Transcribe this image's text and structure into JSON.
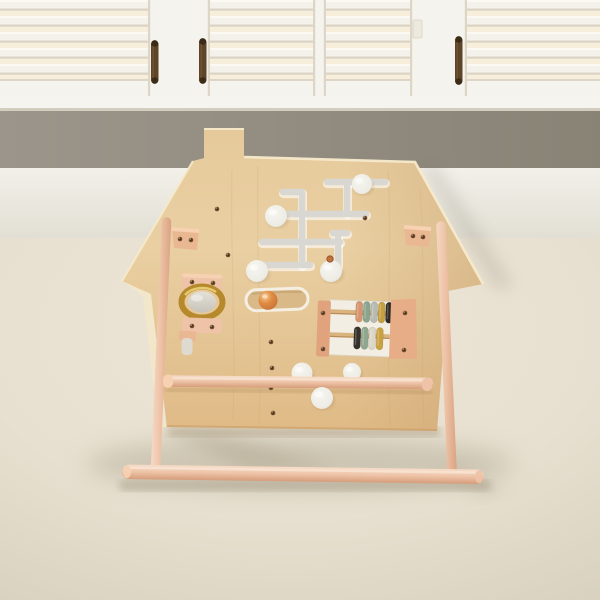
{
  "scene": {
    "subject": "wooden house-shaped activity busy board on an a-frame stand, in front of white plantation shutters on a cream carpet"
  },
  "palette": {
    "shutter_slat_bright": "#fbf9f4",
    "shutter_slat": "#f4f1ea",
    "shutter_gap_shadow": "#dbd3c4",
    "shutter_gap_glow": "#f7eedc",
    "shutter_frame": "#f5f3ee",
    "shutter_frame_shadow": "#ddd5c6",
    "rod": "#5f4527",
    "rod_dark": "#3c2b17",
    "sill": "#f6f4ef",
    "sill_shadow": "#d3cdc0",
    "wall_gray_left": "#9b958b",
    "wall_gray_right": "#898376",
    "wall_lower": "#f2f0e9",
    "wall_lower_dark": "#e2dfd4",
    "floor": "#e7e0d0",
    "floor_light": "#ede6d7",
    "floor_dark": "#d8d0bd",
    "shadow": "#b3aa94",
    "board_top": "#e6ca9c",
    "board_mid": "#e9cfa2",
    "board_bottom": "#dfba86",
    "board_dark": "#c89a64",
    "board_edge": "#f7eacb",
    "board_cut": "#f3e7c9",
    "grain": "#c29a68",
    "stand_light": "#f6dcc8",
    "stand_mid": "#eec3a7",
    "stand_dark": "#d59d7b",
    "bracket": "#eab793",
    "bracket_light": "#f6d2b2",
    "track": "#d9d7d2",
    "knob_center": "#f7f5ef",
    "knob_edge": "#d7d4ca",
    "screw": "#6e4a2c",
    "gold": "#b68a2c",
    "gold_hi": "#ecd077",
    "mirror_top": "#e4e1d9",
    "mirror_bottom": "#c7c3b9",
    "slot_fill": "#d9b988",
    "slot_edge": "#f4efe2",
    "slot_shadow": "#bb9768",
    "ball": "#e08c44",
    "ball_dark": "#c06a32",
    "ball_hi": "#f7c98e",
    "peg": "#c0703e",
    "abacus_bg": "#f2eee3",
    "abacus_post": "#e0a37e",
    "abacus_plate": "#e7ad86",
    "rail_wood": "#dab47f",
    "rail_wood_dark": "#b98c57"
  },
  "shutters": {
    "dividers": [
      {
        "x": 148,
        "w": 62
      },
      {
        "x": 313,
        "w": 13
      },
      {
        "x": 410,
        "w": 57
      }
    ],
    "rods": [
      {
        "x": 151,
        "y": 41,
        "h": 42
      },
      {
        "x": 199,
        "y": 39,
        "h": 44
      },
      {
        "x": 455,
        "y": 37,
        "h": 47
      }
    ]
  },
  "maze": {
    "tracks": [
      [
        327,
        182,
        385,
        182
      ],
      [
        347,
        184,
        347,
        213
      ],
      [
        288,
        214,
        366,
        214
      ],
      [
        283,
        192,
        300,
        192
      ],
      [
        302,
        192,
        302,
        265
      ],
      [
        262,
        242,
        340,
        242
      ],
      [
        333,
        233,
        347,
        233
      ],
      [
        338,
        233,
        338,
        266
      ],
      [
        262,
        265,
        310,
        265
      ]
    ],
    "knobs": [
      [
        362,
        184,
        10
      ],
      [
        276,
        216,
        11
      ],
      [
        257,
        271,
        11
      ],
      [
        331,
        271,
        11
      ]
    ],
    "peg": [
      330,
      259
    ]
  },
  "board_knobs": {
    "behind_bar": [
      [
        302,
        373,
        10.5
      ],
      [
        352,
        372,
        9
      ]
    ],
    "front": [
      [
        322,
        398,
        11
      ]
    ]
  },
  "screws": [
    [
      217,
      209
    ],
    [
      228,
      255
    ],
    [
      271,
      342
    ],
    [
      272,
      368
    ],
    [
      271,
      388
    ],
    [
      273,
      413
    ],
    [
      365,
      218
    ],
    [
      180,
      239
    ],
    [
      191,
      240
    ],
    [
      413,
      236
    ],
    [
      423,
      237
    ],
    [
      192,
      282
    ],
    [
      213,
      283
    ],
    [
      192,
      326
    ],
    [
      212,
      327
    ],
    [
      323,
      313
    ],
    [
      323,
      349
    ],
    [
      405,
      313
    ],
    [
      404,
      350
    ]
  ],
  "abacus": {
    "top_beads": [
      "#d6946f",
      "#8aa58b",
      "#b6bab0",
      "#c69f3f",
      "#2e2b26"
    ],
    "bottom_beads": [
      "#36322b",
      "#90a78f",
      "#dcd6c6",
      "#c9a23f"
    ]
  }
}
